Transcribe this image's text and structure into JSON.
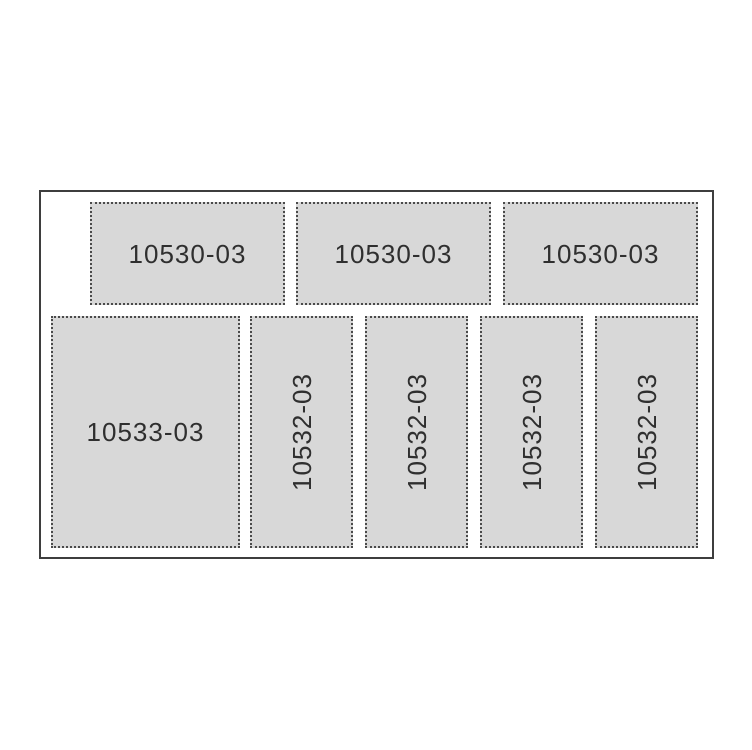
{
  "diagram": {
    "colors": {
      "fill_color": "#d8d8d8",
      "dot_color": "#4a4a4a",
      "outline_color": "#3e3e3e",
      "label_color": "#2f2f2f"
    },
    "boxes": [
      {
        "label": "10530-03",
        "orientation": "horizontal"
      },
      {
        "label": "10530-03",
        "orientation": "horizontal"
      },
      {
        "label": "10530-03",
        "orientation": "horizontal"
      },
      {
        "label": "10533-03",
        "orientation": "horizontal"
      },
      {
        "label": "10532-03",
        "orientation": "vertical"
      },
      {
        "label": "10532-03",
        "orientation": "vertical"
      },
      {
        "label": "10532-03",
        "orientation": "vertical"
      },
      {
        "label": "10532-03",
        "orientation": "vertical"
      }
    ]
  }
}
